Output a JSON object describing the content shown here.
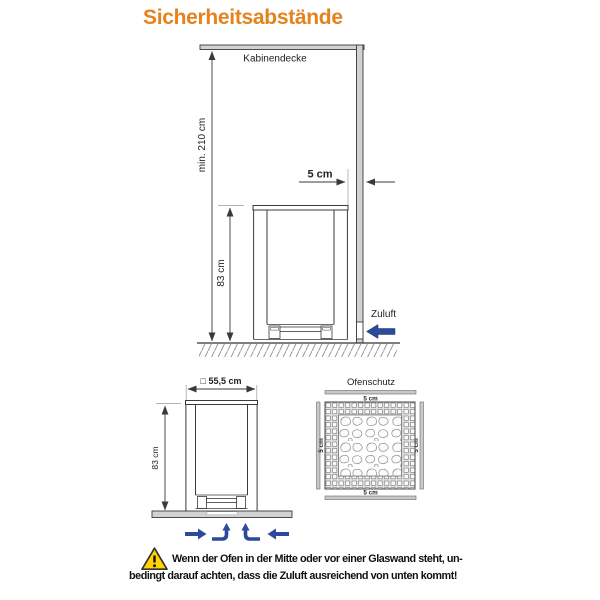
{
  "title": "Sicherheitsabstände",
  "main_diagram": {
    "ceiling_label": "Kabinendecke",
    "min_height": "min. 210 cm",
    "wall_distance": "5 cm",
    "heater_height": "83 cm",
    "air_inlet": "Zuluft"
  },
  "front_view": {
    "width": "□ 55,5 cm",
    "height": "83 cm"
  },
  "floor_plate": {
    "title": "Ofenschutz",
    "margin_top": "5 cm",
    "margin_bottom": "5 cm",
    "margin_left": "5 cm",
    "margin_right": "5 cm"
  },
  "warning": {
    "line1": "Wenn der Ofen in der Mitte oder vor einer Glaswand steht, un-",
    "line2": "bedingt darauf achten, dass die Zuluft ausreichend von unten kommt!"
  },
  "colors": {
    "accent_orange": "#E6821E",
    "line_dark": "#3A3A3A",
    "fill_gray": "#D2D2D2",
    "arrow_blue": "#2B4A9B",
    "warning_yellow": "#FFD200"
  }
}
